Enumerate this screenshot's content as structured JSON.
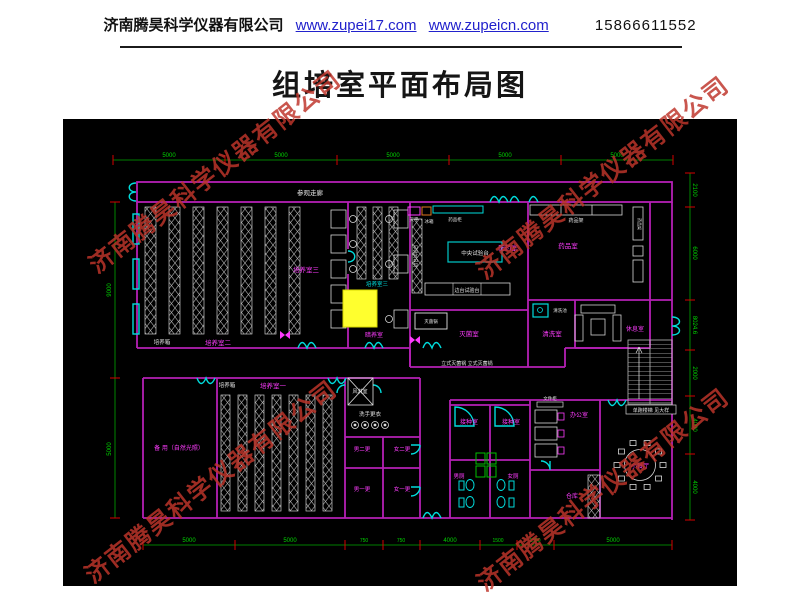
{
  "header": {
    "company": "济南腾昊科学仪器有限公司",
    "url1": "www.zupei17.com",
    "url2": "www.zupeicn.com",
    "phone": "15866611552"
  },
  "title": "组培室平面布局图",
  "watermark": {
    "text": "济南腾昊科学仪器有限公司",
    "color": "#bf352b"
  },
  "plan": {
    "labels": {
      "corridor": "参观走廊",
      "cult1": "培养室一",
      "cult2": "培养室二",
      "cult3": "培养室三",
      "cult3b": "培养室三",
      "dark": "暗养室",
      "incubator1": "培养箱",
      "incubator2": "培养箱",
      "peiyao": "配药室",
      "yaopin": "药品室",
      "miejun": "灭菌室",
      "qingxi": "清洗室",
      "xiuxi": "休息室",
      "backup": "备 用（自然光照）",
      "fenglin": "风淋室",
      "xishou": "洗手更衣",
      "man2": "男二更",
      "woman2": "女二更",
      "man1": "男一更",
      "woman1": "女一更",
      "jiezhong1": "接种室",
      "jiezhong2": "接种室",
      "manwc": "男厕",
      "womanwc": "女厕",
      "office": "办公室",
      "cangku": "仓库",
      "dining": "小餐厅"
    },
    "equipment": {
      "tianping": "天平",
      "bingxiang": "冰箱",
      "yaopingui": "药品柜",
      "central_bench": "中央试验台",
      "side_bench": "边台试验台",
      "side_bench_v": "边台试验台",
      "yaopinjia": "药品架",
      "yaopinjia_v": "药品架",
      "miejunguo": "灭菌锅",
      "lishi_miejunguo": "立式灭菌锅 立式灭菌锅",
      "qingxichi": "清洗池",
      "wenjiangui": "文件柜",
      "stair_note": "单跑楼梯 见大样"
    },
    "dims": {
      "top": [
        "5000",
        "5000",
        "5000",
        "5000",
        "5000"
      ],
      "bottom": [
        "5000",
        "5000",
        "750",
        "750",
        "4000",
        "1500",
        "1500",
        "5000"
      ],
      "left": [
        "9000",
        "5000"
      ],
      "right": [
        "2100",
        "6000",
        "8024.6",
        "2000",
        "4000",
        "4000"
      ]
    },
    "colors": {
      "wall": "#b520b5",
      "label": "#ff3cff",
      "cyan": "#00e0e0",
      "dim_line": "#00a800",
      "dim_text": "#00d400",
      "tick": "#d40000",
      "highlight": "#ffff2e"
    }
  }
}
